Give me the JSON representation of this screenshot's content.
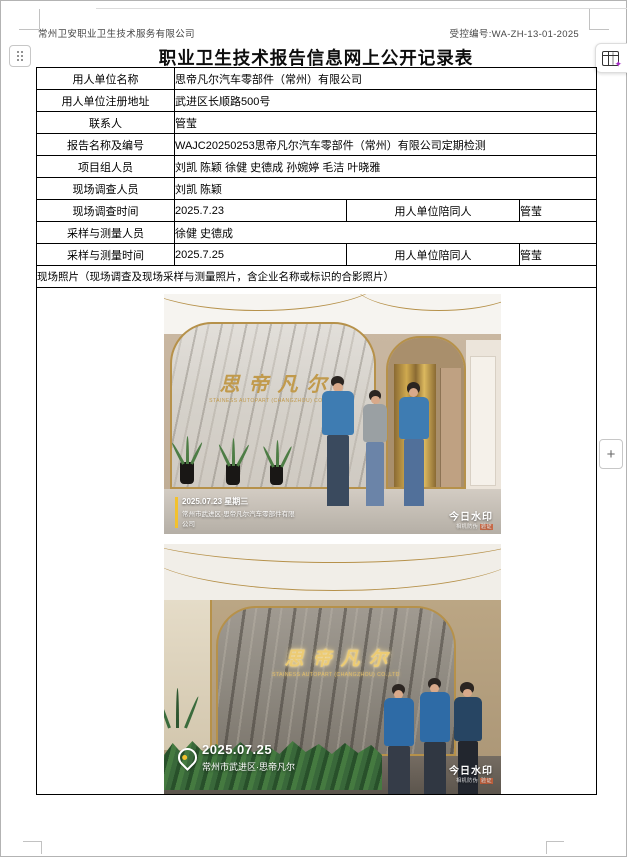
{
  "window": {
    "header_left": "常州卫安职业卫生技术服务有限公司",
    "header_right": "受控编号:WA-ZH-13-01-2025",
    "title": "职业卫生技术报告信息网上公开记录表"
  },
  "toolbar": {
    "plus_label": "+"
  },
  "table": {
    "rows": [
      {
        "label": "用人单位名称",
        "value": "思帝凡尔汽车零部件（常州）有限公司"
      },
      {
        "label": "用人单位注册地址",
        "value": "武进区长顺路500号"
      },
      {
        "label": "联系人",
        "value": "管莹"
      },
      {
        "label": "报告名称及编号",
        "value": "WAJC20250253思帝凡尔汽车零部件（常州）有限公司定期检测"
      },
      {
        "label": "项目组人员",
        "value": "刘凯 陈颖 徐健 史德成 孙婉婷 毛洁 叶晓雅"
      },
      {
        "label": "现场调查人员",
        "value": "刘凯 陈颖"
      },
      {
        "label": "现场调查时间",
        "value": "2025.7.23",
        "sub_label": "用人单位陪同人",
        "sub_value": "管莹"
      },
      {
        "label": "采样与测量人员",
        "value": "徐健 史德成"
      },
      {
        "label": "采样与测量时间",
        "value": "2025.7.25",
        "sub_label": "用人单位陪同人",
        "sub_value": "管莹"
      }
    ],
    "photos_header": "现场照片（现场调查及现场采样与测量照片，含企业名称或标识的合影照片）"
  },
  "photo1": {
    "wall_text_cn": "思帝凡尔",
    "wall_text_en": "STAINESS AUTOPART (CHANGZHOU) CO.,LTD",
    "watermark_line1": "2025.07.23 星期三",
    "watermark_line2": "常州市武进区·思帝凡尔汽车零部件有限",
    "watermark_line3": "公司",
    "stamp_title": "今日水印",
    "stamp_sub": "相机防伪"
  },
  "photo2": {
    "wall_text_cn": "思帝凡尔",
    "wall_text_en": "STAINESS AUTOPART (CHANGZHOU) CO.,LTD",
    "watermark_date": "2025.07.25",
    "watermark_location": "常州市武进区·思帝凡尔",
    "stamp_title": "今日水印",
    "stamp_sub": "相机防伪"
  },
  "colors": {
    "gold": "#b6914a",
    "marble-gold-text": "#c19a4c",
    "jacket-blue-1": "#3e7cb2",
    "jacket-blue-2": "#2e6ba6",
    "watermark-yellow": "#f2c12e",
    "extension-purple": "#a62bc4"
  }
}
